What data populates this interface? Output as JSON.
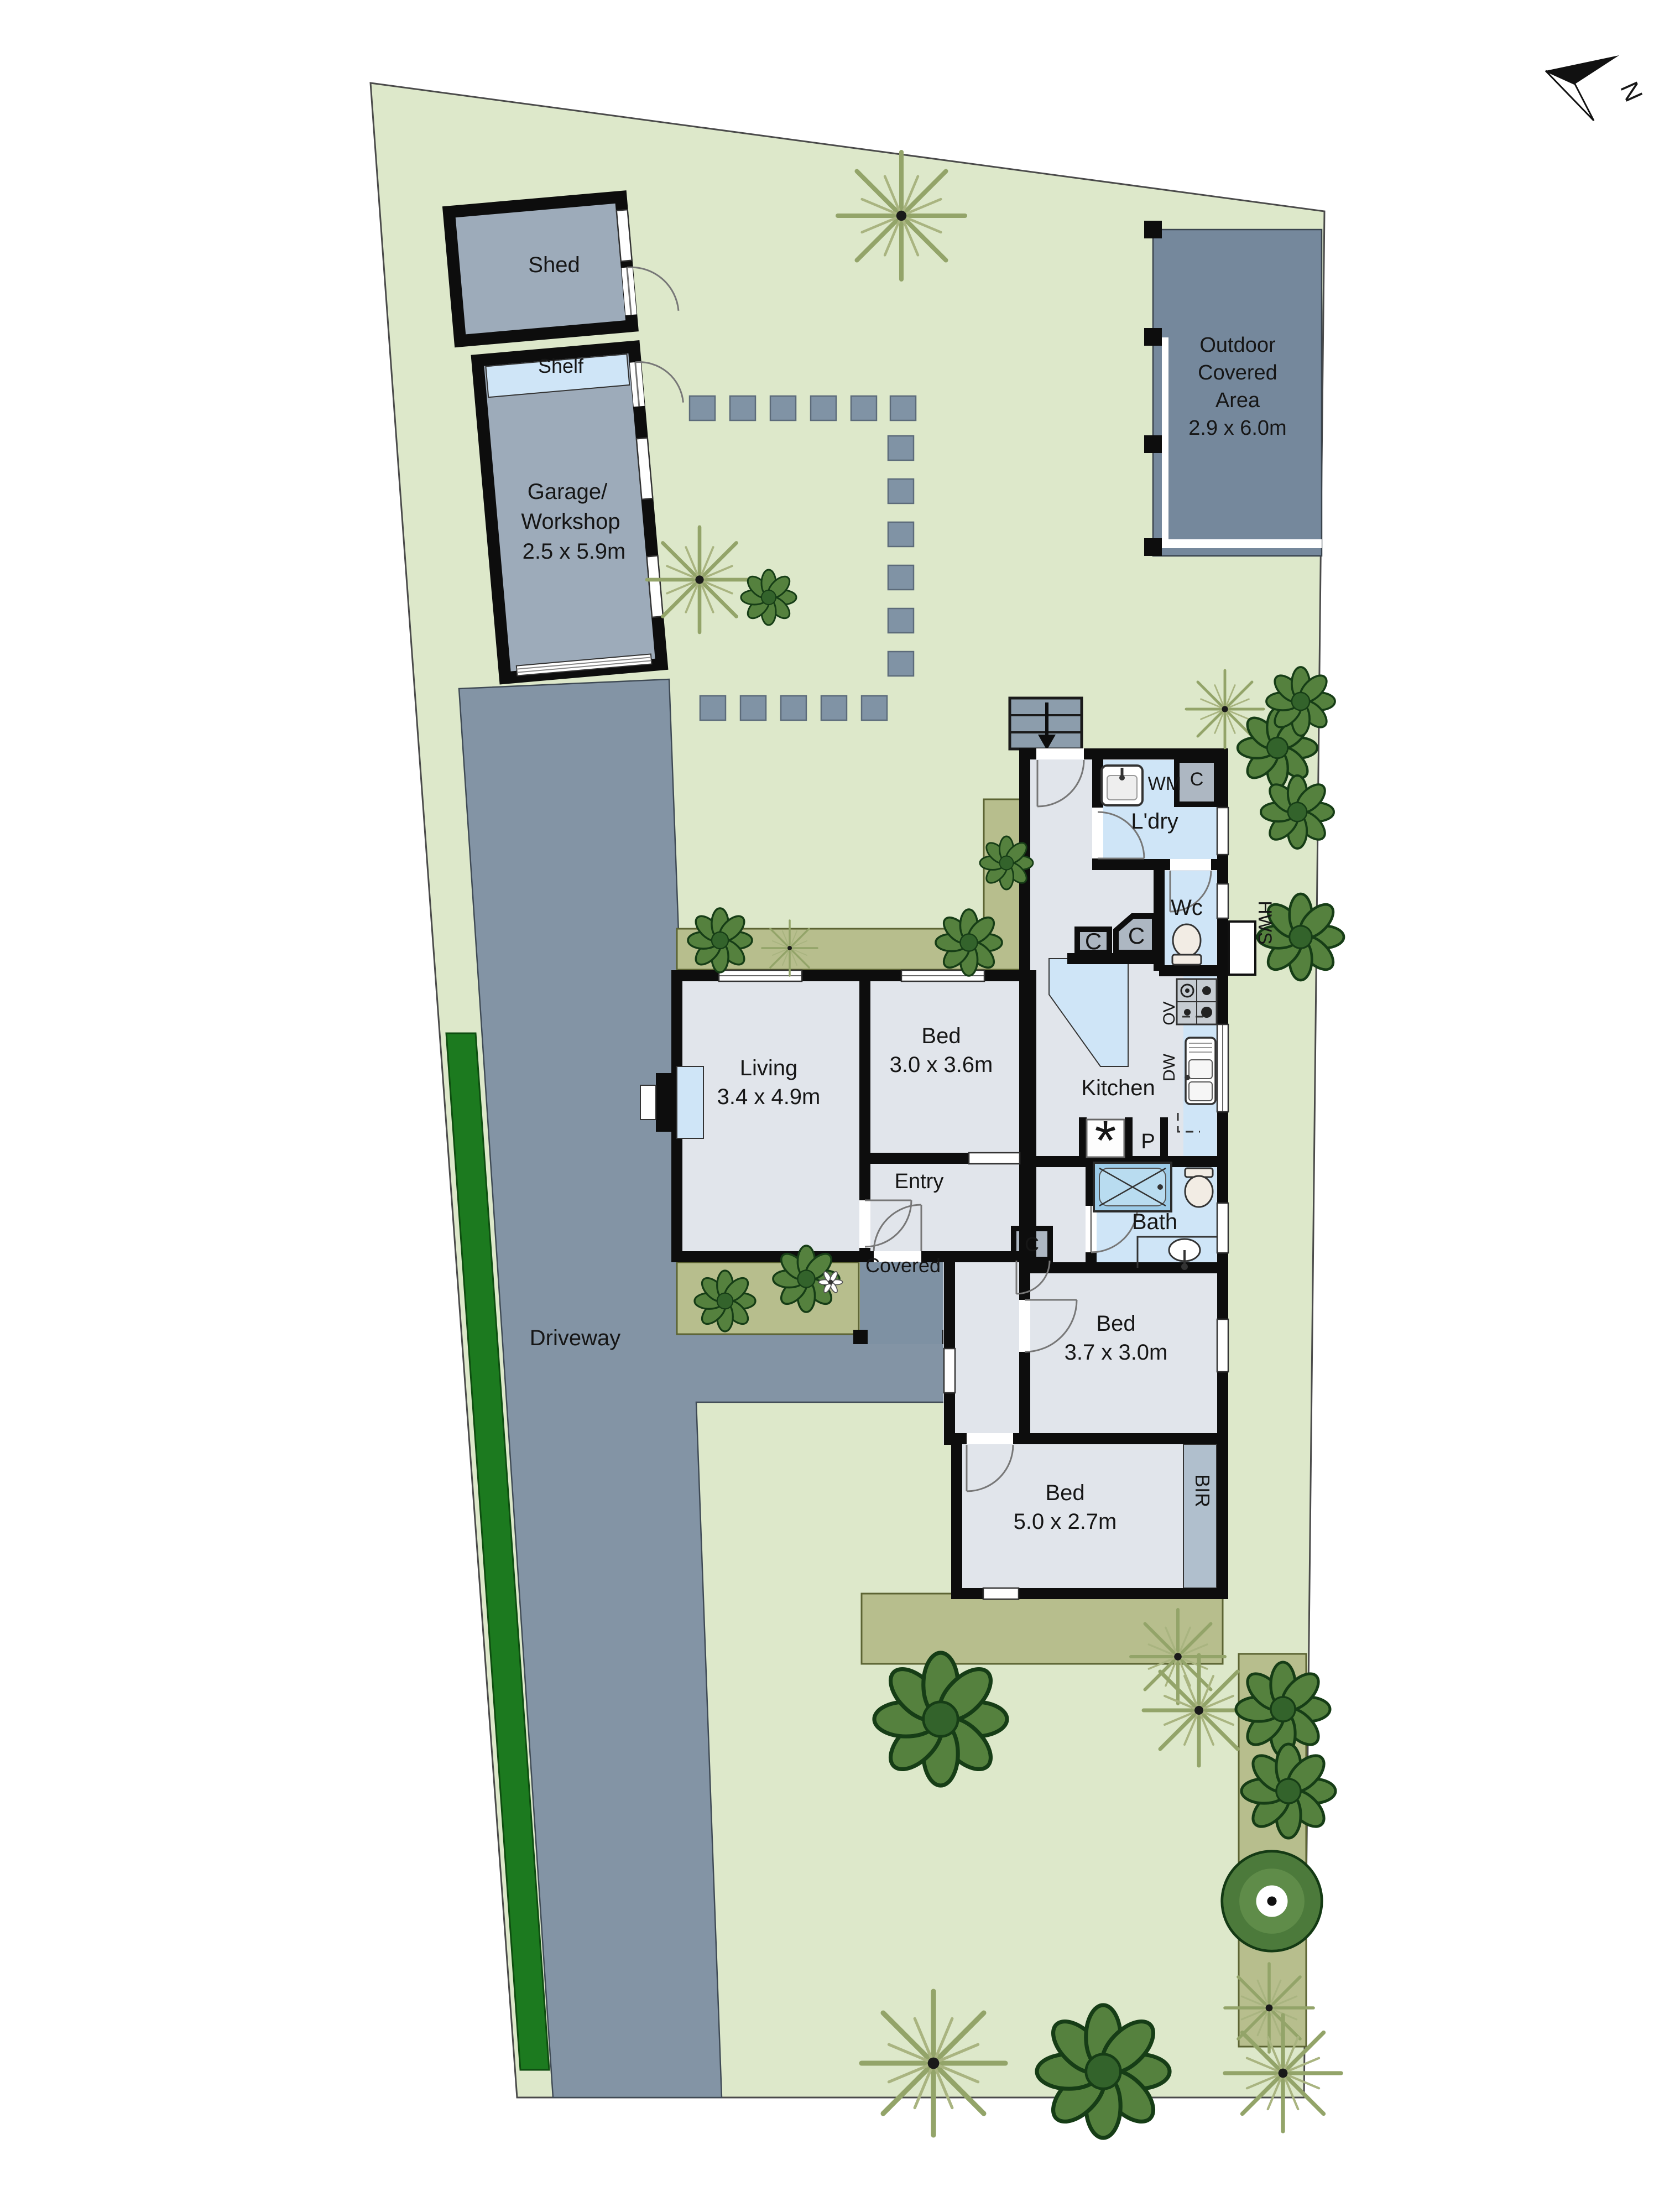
{
  "north": {
    "label": "N"
  },
  "site": {
    "driveway": "Driveway"
  },
  "outbuildings": {
    "shed": "Shed",
    "shelf": "Shelf",
    "garage_l1": "Garage/",
    "garage_l2": "Workshop",
    "garage_dim": "2.5 x 5.9m",
    "outdoor_l1": "Outdoor",
    "outdoor_l2": "Covered",
    "outdoor_l3": "Area",
    "outdoor_dim": "2.9 x 6.0m"
  },
  "rooms": {
    "living": "Living",
    "living_dim": "3.4 x 4.9m",
    "bed1": "Bed",
    "bed1_dim": "3.0 x 3.6m",
    "bed2": "Bed",
    "bed2_dim": "3.7 x 3.0m",
    "bed3": "Bed",
    "bed3_dim": "5.0 x 2.7m",
    "kitchen": "Kitchen",
    "bath": "Bath",
    "laundry": "L'dry",
    "wc": "Wc",
    "entry": "Entry",
    "covered": "Covered"
  },
  "fixtures": {
    "wm": "WM",
    "closet": "C",
    "hws": "HWS",
    "oven": "OV",
    "dishwasher": "DW",
    "pantry": "P",
    "fridge_symbol": "*",
    "bir": "BIR"
  },
  "colors": {
    "lawn": "#dde8ca",
    "garden_bed": "#b7be8d",
    "driveway": "#8394a5",
    "outdoor_area": "#75889c",
    "outbuilding": "#9dabba",
    "wet_room": "#cfe5f7",
    "floor": "#e1e5eb",
    "wall": "#0d0d0d",
    "hedge": "#1c7a1f"
  }
}
